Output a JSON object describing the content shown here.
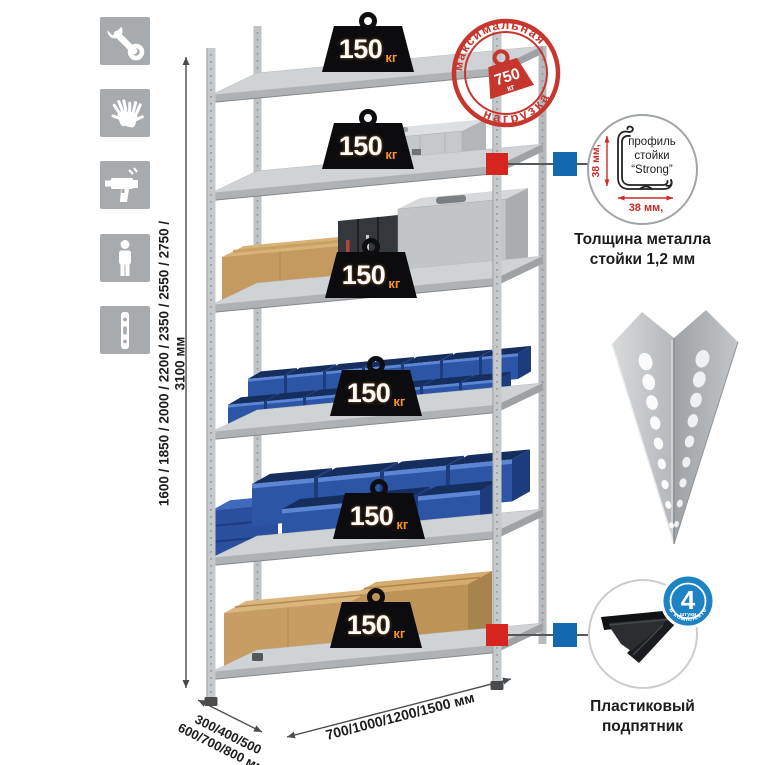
{
  "sidebar": {
    "icons": [
      {
        "name": "wrench"
      },
      {
        "name": "gloves"
      },
      {
        "name": "drill"
      },
      {
        "name": "person"
      },
      {
        "name": "upright-profile"
      }
    ]
  },
  "dimensions": {
    "height": "1600 / 1850 / 2000 / 2200 / 2350 / 2550 / 2750 / 3100 мм",
    "depth_line1": "300/400/500",
    "depth_line2": "600/700/800 мм",
    "width": "700/1000/1200/1500 мм"
  },
  "shelf_badges": [
    {
      "value": "150",
      "unit": "кг"
    },
    {
      "value": "150",
      "unit": "кг"
    },
    {
      "value": "150",
      "unit": "кг"
    },
    {
      "value": "150",
      "unit": "кг"
    },
    {
      "value": "150",
      "unit": "кг"
    },
    {
      "value": "150",
      "unit": "кг"
    }
  ],
  "stamp": {
    "arc_top": "максимальная",
    "arc_bottom": "нагрузка",
    "value": "750",
    "unit": "кг"
  },
  "profile_detail": {
    "label_line1": "профиль",
    "label_line2": "стойки",
    "label_line3": "“Strong”",
    "dim_vertical": "38 мм,",
    "dim_horizontal": "38 мм,",
    "caption_line1": "Толщина металла",
    "caption_line2": "стойки 1,2 мм"
  },
  "foot_detail": {
    "badge_number": "4",
    "badge_sub": "штуки",
    "badge_arc": "в комплекте",
    "caption_line1": "Пластиковый",
    "caption_line2": "подпятник"
  },
  "colors": {
    "accent_red": "#c7362d",
    "connector_red": "#d6251f",
    "connector_blue": "#1368b0",
    "badge_black": "#0c0c0e",
    "badge_unit_orange": "#f7941d",
    "bin_blue": "#2c55a6",
    "metal_gray": "#c6c9cc",
    "cardboard": "#c59a61",
    "icon_square_gray": "#a8abae"
  }
}
